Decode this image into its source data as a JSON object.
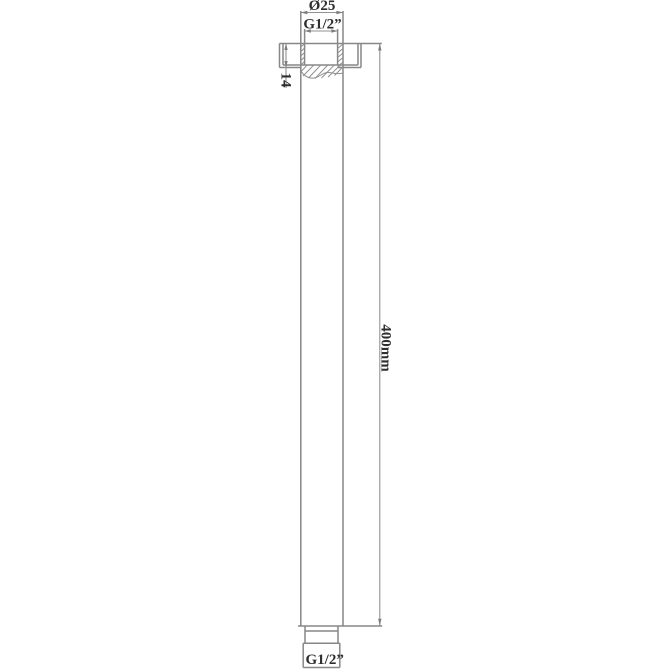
{
  "drawing": {
    "title": "Ceiling-mounted shower arm dimensional drawing",
    "labels": {
      "top_diameter": "Ø25",
      "top_thread": "G1/2”",
      "flange_depth": "14",
      "arm_length": "400mm",
      "bottom_thread": "G1/2”"
    },
    "colors": {
      "line": "#878787",
      "text": "#2e2e2e",
      "background": "#ffffff"
    }
  }
}
